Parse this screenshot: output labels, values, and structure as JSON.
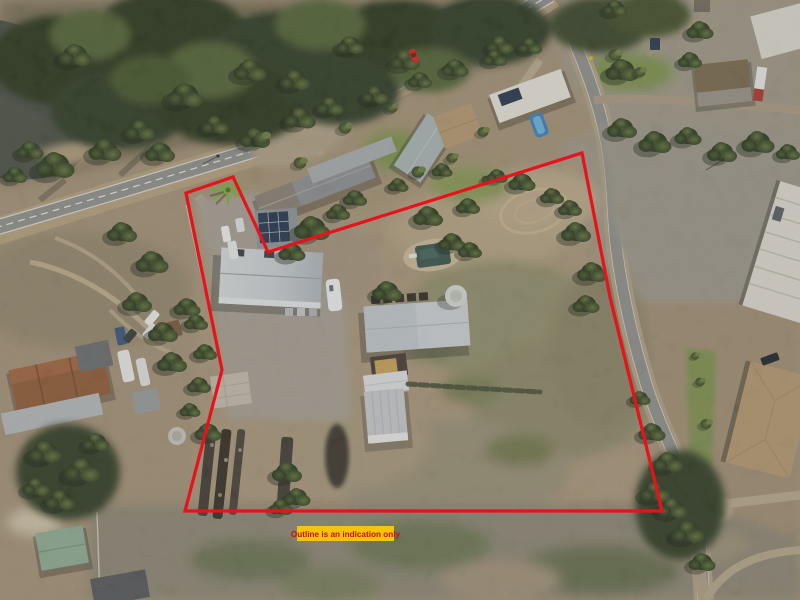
{
  "overlay": {
    "disclaimer": "Outline is an indication only",
    "outline_color": "#E8121B",
    "outline_points": "186,193 233,177 268,252 582,153 610,297 662,511 185,511 222,370",
    "label_bg": "#F4C50B",
    "label_text_color": "#C31112"
  },
  "scene": {
    "features": [
      "river",
      "bushland",
      "highway",
      "side-road",
      "dirt-tracks",
      "gravel-yard",
      "main-shed",
      "solar-panel-shed",
      "machinery-shed",
      "hay-shed",
      "storage-sheds",
      "water-tank",
      "dam",
      "exercise-track",
      "scrap-rows",
      "caravan",
      "vehicles",
      "palm-tree",
      "neighbour-houses",
      "swimming-pool",
      "industrial-sheds",
      "tan-roof-house",
      "terracotta-roof-house",
      "green-shed",
      "scrub-paddock"
    ],
    "palette": {
      "water": "#4e544a",
      "forest_dark": "#2e3b24",
      "forest_mid": "#3c4a2e",
      "tree_light": "#6d7f48",
      "scrub_base": "#a5947a",
      "scrub_grey": "#8e8877",
      "dirt_light": "#b7a484",
      "road_sealed": "#90938e",
      "road_dirt": "#b3a285",
      "gravel": "#9d998d",
      "roof_light_grey": "#cdd2d5",
      "roof_white": "#e6e3da",
      "roof_tan": "#b59a74",
      "roof_terracotta": "#925f3c",
      "roof_teal_grey": "#a8b6b6",
      "green_shed": "#8fae96",
      "solar_panels": "#2b3b54",
      "pool_blue": "#3e85c0",
      "dam_water": "#3d5852",
      "hay": "#c9a45c",
      "car_red": "#c23026"
    }
  }
}
